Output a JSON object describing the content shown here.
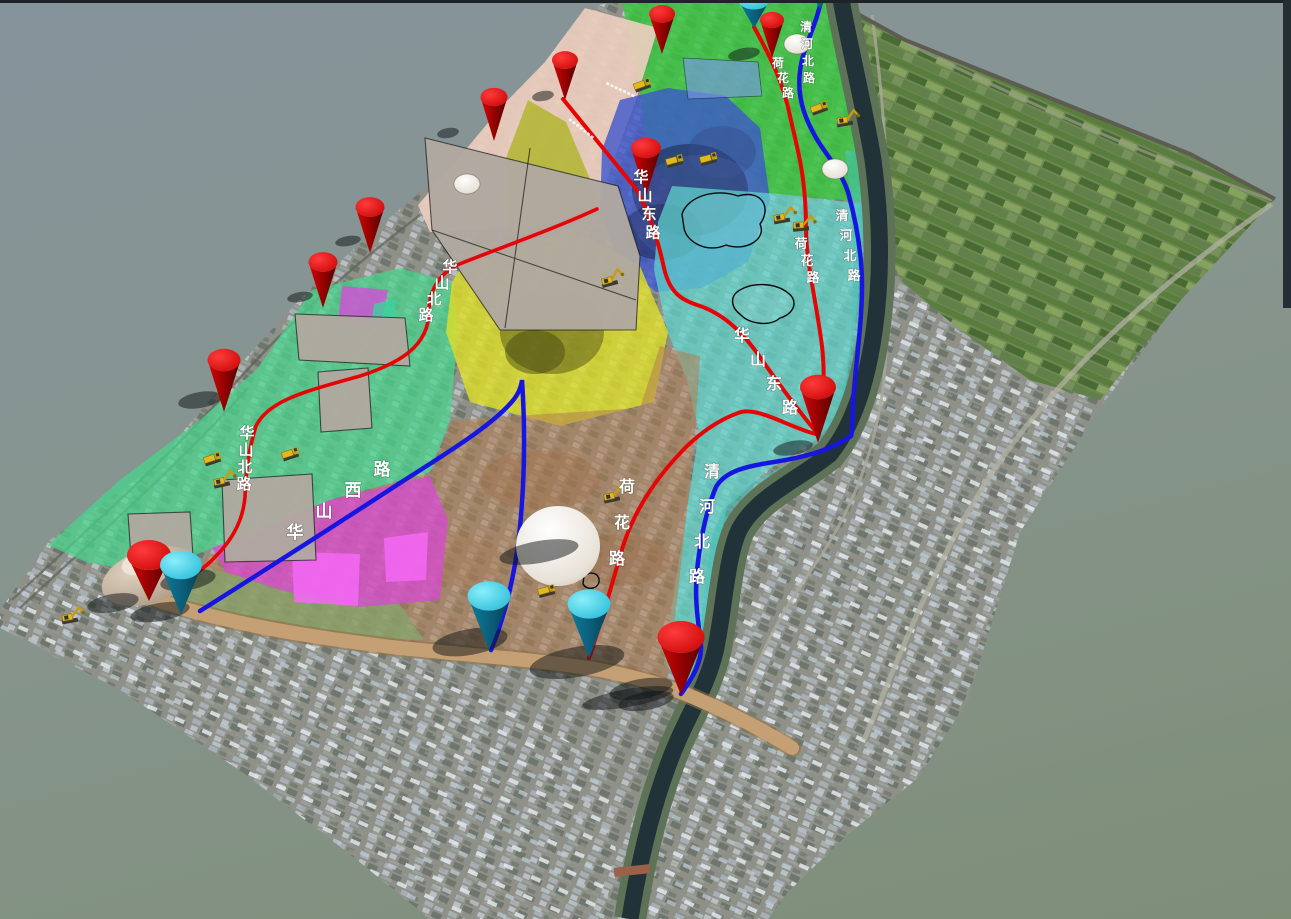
{
  "scene": {
    "type": "3d-terrain-planning-viewport",
    "background_top": "#8796A0",
    "background_bottom": "#7E8E77",
    "description": "Tilted 3D aerial model of an urban district with colored land-use overlay zones, road lines and cone markers"
  },
  "roads": {
    "red_color": "#E60505",
    "blue_color": "#1616E0",
    "construction_road_color": "#C6A075",
    "names": [
      {
        "name": "华山北路",
        "color": "red"
      },
      {
        "name": "华山东路",
        "color": "red"
      },
      {
        "name": "荷花路",
        "color": "red"
      },
      {
        "name": "华山西路",
        "color": "blue"
      },
      {
        "name": "清河北路",
        "color": "blue"
      }
    ]
  },
  "road_labels": [
    {
      "text": "华山北路",
      "x": 450,
      "y": 272,
      "dx": -8,
      "dy": 16,
      "size": 15
    },
    {
      "text": "华山北路",
      "x": 247,
      "y": 438,
      "dx": -1,
      "dy": 17,
      "size": 15
    },
    {
      "text": "华山东路",
      "x": 641,
      "y": 182,
      "dx": 4,
      "dy": 18.5,
      "size": 15
    },
    {
      "text": "华山东路",
      "x": 742,
      "y": 341,
      "dx": 16,
      "dy": 24,
      "size": 16
    },
    {
      "text": "华山西路",
      "x": 295,
      "y": 538,
      "dx": 29,
      "dy": -21,
      "size": 17
    },
    {
      "text": "荷花路",
      "x": 778,
      "y": 67,
      "dx": 5,
      "dy": 15,
      "size": 12
    },
    {
      "text": "荷花路",
      "x": 801,
      "y": 248,
      "dx": 6,
      "dy": 17,
      "size": 13
    },
    {
      "text": "荷花路",
      "x": 627,
      "y": 492,
      "dx": -5,
      "dy": 36,
      "size": 16
    },
    {
      "text": "清河北路",
      "x": 806,
      "y": 31,
      "dx": 1,
      "dy": 17,
      "size": 12
    },
    {
      "text": "清河北路",
      "x": 842,
      "y": 220,
      "dx": 4,
      "dy": 20,
      "size": 13
    },
    {
      "text": "清河北路",
      "x": 712,
      "y": 477,
      "dx": -5,
      "dy": 35,
      "size": 16
    }
  ],
  "zones": [
    {
      "id": "north-green",
      "color": "#34C83C"
    },
    {
      "id": "west-green",
      "color": "#46D78C"
    },
    {
      "id": "mountain-blue",
      "color": "#3C55CD"
    },
    {
      "id": "east-teal",
      "color": "#5FD7CD"
    },
    {
      "id": "central-yellow",
      "color": "#DEDE28"
    },
    {
      "id": "olive-strip",
      "color": "#AFB428"
    },
    {
      "id": "northwest-corridor-tan",
      "color": "#E6CABB"
    },
    {
      "id": "south-brown",
      "color": "#B47D50"
    },
    {
      "id": "southwest-magenta",
      "color": "#DC46DC"
    },
    {
      "id": "gray-parcels",
      "color": "#B0A9A0"
    }
  ],
  "river": {
    "color": "#223239",
    "bank_color": "#5E7257"
  },
  "markers": {
    "red_cone_color": "#E00000",
    "cyan_cone_color": "#35D3EC",
    "red_cones": [
      {
        "x": 565,
        "y": 100,
        "w": 26,
        "h": 40
      },
      {
        "x": 662,
        "y": 54,
        "w": 26,
        "h": 40
      },
      {
        "x": 772,
        "y": 58,
        "w": 24,
        "h": 38
      },
      {
        "x": 494,
        "y": 141,
        "w": 27,
        "h": 44
      },
      {
        "x": 646,
        "y": 196,
        "w": 30,
        "h": 48
      },
      {
        "x": 370,
        "y": 253,
        "w": 29,
        "h": 46
      },
      {
        "x": 323,
        "y": 308,
        "w": 29,
        "h": 46
      },
      {
        "x": 224,
        "y": 412,
        "w": 33,
        "h": 52
      },
      {
        "x": 818,
        "y": 443,
        "w": 36,
        "h": 56
      },
      {
        "x": 681,
        "y": 695,
        "w": 47,
        "h": 58
      },
      {
        "x": 149,
        "y": 601,
        "w": 44,
        "h": 46
      }
    ],
    "cyan_cones": [
      {
        "x": 754,
        "y": 28,
        "w": 34,
        "h": 30
      },
      {
        "x": 820,
        "y": 9,
        "w": 16,
        "h": 14
      },
      {
        "x": 181,
        "y": 615,
        "w": 42,
        "h": 50
      },
      {
        "x": 489,
        "y": 650,
        "w": 43,
        "h": 54
      },
      {
        "x": 589,
        "y": 658,
        "w": 43,
        "h": 54
      }
    ]
  },
  "vehicles": {
    "color": "#E3B91E",
    "items": [
      {
        "x": 643,
        "y": 88,
        "rot": -20,
        "type": "truck"
      },
      {
        "x": 675,
        "y": 164,
        "rot": -15,
        "type": "truck"
      },
      {
        "x": 709,
        "y": 162,
        "rot": -15,
        "type": "truck"
      },
      {
        "x": 782,
        "y": 221,
        "rot": -10,
        "type": "excavator"
      },
      {
        "x": 801,
        "y": 229,
        "rot": -5,
        "type": "excavator"
      },
      {
        "x": 820,
        "y": 111,
        "rot": -20,
        "type": "truck"
      },
      {
        "x": 845,
        "y": 124,
        "rot": -10,
        "type": "excavator"
      },
      {
        "x": 610,
        "y": 284,
        "rot": -15,
        "type": "excavator"
      },
      {
        "x": 213,
        "y": 462,
        "rot": -18,
        "type": "truck"
      },
      {
        "x": 222,
        "y": 485,
        "rot": -12,
        "type": "excavator"
      },
      {
        "x": 291,
        "y": 457,
        "rot": -18,
        "type": "truck"
      },
      {
        "x": 612,
        "y": 500,
        "rot": -12,
        "type": "excavator"
      },
      {
        "x": 547,
        "y": 594,
        "rot": -15,
        "type": "truck"
      },
      {
        "x": 70,
        "y": 621,
        "rot": -10,
        "type": "excavator"
      }
    ]
  },
  "tiny_labels": [
    {
      "x": 607,
      "y": 82,
      "rot": 25,
      "illegible": true
    },
    {
      "x": 570,
      "y": 118,
      "rot": 38,
      "illegible": true
    }
  ],
  "shadows": [
    {
      "x": 744,
      "y": 54,
      "rx": 16,
      "ry": 6
    },
    {
      "x": 200,
      "y": 400,
      "rx": 22,
      "ry": 8
    },
    {
      "x": 470,
      "y": 642,
      "rx": 38,
      "ry": 13
    },
    {
      "x": 577,
      "y": 662,
      "rx": 48,
      "ry": 15
    },
    {
      "x": 641,
      "y": 689,
      "rx": 32,
      "ry": 10
    },
    {
      "x": 628,
      "y": 698,
      "rx": 46,
      "ry": 9
    },
    {
      "x": 113,
      "y": 603,
      "rx": 26,
      "ry": 9
    },
    {
      "x": 543,
      "y": 96,
      "rx": 11,
      "ry": 5
    },
    {
      "x": 448,
      "y": 133,
      "rx": 11,
      "ry": 5
    },
    {
      "x": 348,
      "y": 241,
      "rx": 13,
      "ry": 5
    },
    {
      "x": 300,
      "y": 297,
      "rx": 13,
      "ry": 5
    },
    {
      "x": 188,
      "y": 580,
      "rx": 28,
      "ry": 10
    },
    {
      "x": 793,
      "y": 448,
      "rx": 20,
      "ry": 7
    },
    {
      "x": 646,
      "y": 701,
      "rx": 28,
      "ry": 9
    },
    {
      "x": 539,
      "y": 552,
      "rx": 40,
      "ry": 11
    },
    {
      "x": 160,
      "y": 612,
      "rx": 30,
      "ry": 9
    }
  ]
}
